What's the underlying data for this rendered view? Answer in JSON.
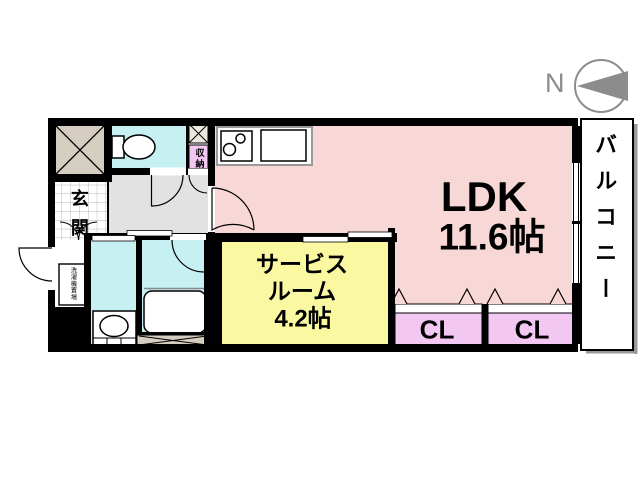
{
  "compass": {
    "label": "N",
    "icon": "north-arrow-left"
  },
  "rooms": {
    "ldk": {
      "label": "LDK",
      "size": "11.6帖"
    },
    "service_room": {
      "line1": "サービス",
      "line2": "ルーム",
      "size": "4.2帖"
    },
    "closet_left": {
      "label": "CL"
    },
    "closet_right": {
      "label": "CL"
    },
    "balcony": {
      "label": "バルコニー"
    },
    "entrance": {
      "label": "玄関"
    },
    "storage": {
      "label": "収納"
    },
    "laundry": {
      "label": "洗濯機置場"
    }
  },
  "colors": {
    "ldk_pink": "#F8D7D7",
    "service_yellow": "#FAF9A2",
    "water_cyan": "#C7F0F2",
    "closet_purple": "#F2C7F2",
    "shaft_beige": "#D5CEC0",
    "hallway_gray": "#E2E2E2",
    "wall_black": "#000000",
    "compass_gray": "#8C8C8C"
  }
}
